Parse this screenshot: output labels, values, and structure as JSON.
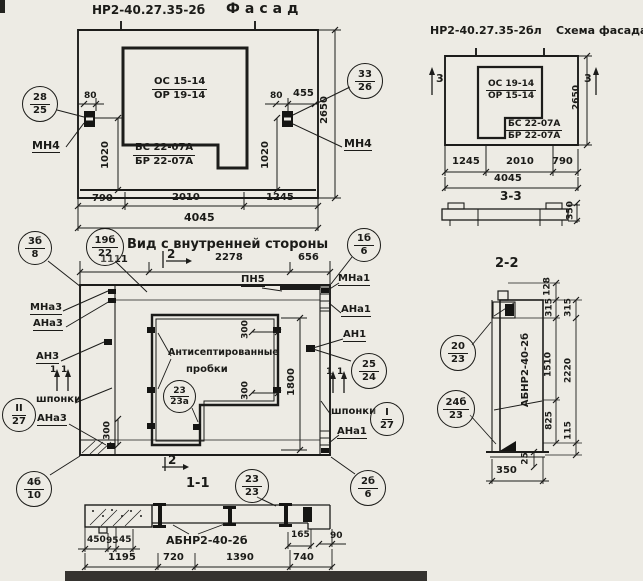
{
  "facade": {
    "code": "НР2-40.27.35-2б",
    "title": "Фасад",
    "window_mark": {
      "top": "ОС 15-14",
      "bottom": "ОР 19-14"
    },
    "block_mark": {
      "top": "БС 22-07А",
      "bottom": "БР 22-07А"
    },
    "node_left": {
      "top": "28",
      "bottom": "25"
    },
    "node_right": {
      "top": "33",
      "bottom": "26"
    },
    "anchor_left": "МН4",
    "anchor_right": "МН4",
    "dims": {
      "d80_left": "80",
      "d1020_left": "1020",
      "d80_right": "80",
      "d455": "455",
      "d1020_right": "1020",
      "height": "2650",
      "bottom": [
        "790",
        "2010",
        "1245"
      ],
      "total": "4045"
    }
  },
  "scheme": {
    "code": "НР2-40.27.35-2бл",
    "title": "Схема фасада",
    "window_mark": {
      "top": "ОС 19-14",
      "bottom": "ОР 15-14"
    },
    "block_mark": {
      "top": "БС 22-07А",
      "bottom": "БР 22-07А"
    },
    "section_mark": "3",
    "dims": {
      "height": "2650",
      "bottom": [
        "1245",
        "2010",
        "790"
      ],
      "total": "4045"
    }
  },
  "section33": {
    "title": "3-3",
    "thickness": "350"
  },
  "inner": {
    "title": "Вид с внутренней стороны",
    "top_dims": [
      "1111",
      "2278",
      "656"
    ],
    "sec2": "2",
    "sec1": "1",
    "pn5": "ПН5",
    "note_line1": "Антисептированные",
    "note_line2": "пробки",
    "labels_left": {
      "mna3": "МНа3",
      "ana3_top": "АНа3",
      "an3": "АН3",
      "shponki": "шпонки",
      "ana3_bottom": "АНа3"
    },
    "labels_right": {
      "mna1": "МНа1",
      "ana1_top": "АНа1",
      "an1": "АН1",
      "shponki": "шпонки",
      "ana1_bottom": "АНа1"
    },
    "nodes": {
      "tl": {
        "top": "3б",
        "bottom": "8"
      },
      "tl2": {
        "top": "19б",
        "bottom": "22"
      },
      "tr": {
        "top": "1б",
        "bottom": "6"
      },
      "bl": {
        "top": "4б",
        "bottom": "10"
      },
      "br": {
        "top": "2б",
        "bottom": "6"
      },
      "center": {
        "top": "23",
        "bottom": "23а"
      },
      "right": {
        "top": "25",
        "bottom": "24"
      },
      "key_left": {
        "top": "II",
        "bottom": "27"
      },
      "key_right": {
        "top": "I",
        "bottom": "27"
      },
      "bottom": {
        "top": "23",
        "bottom": "23"
      }
    },
    "dims": {
      "d300": "300",
      "d1800": "1800"
    }
  },
  "section11": {
    "title": "1-1",
    "label": "АБНР2-40-2б",
    "dims_small": [
      "450",
      "95",
      "45"
    ],
    "d165": "165",
    "d90": "90",
    "dims_bottom": [
      "1195",
      "720",
      "1390",
      "740"
    ]
  },
  "section22": {
    "title": "2-2",
    "label": "АБНР2-40-2б",
    "nodes": {
      "top": {
        "top": "20",
        "bottom": "23"
      },
      "bottom": {
        "top": "24б",
        "bottom": "23"
      }
    },
    "dims_inner": [
      "128",
      "315",
      "1510",
      "825"
    ],
    "dims_outer": [
      "315",
      "2220",
      "115"
    ],
    "d25": "25",
    "d350": "350"
  }
}
